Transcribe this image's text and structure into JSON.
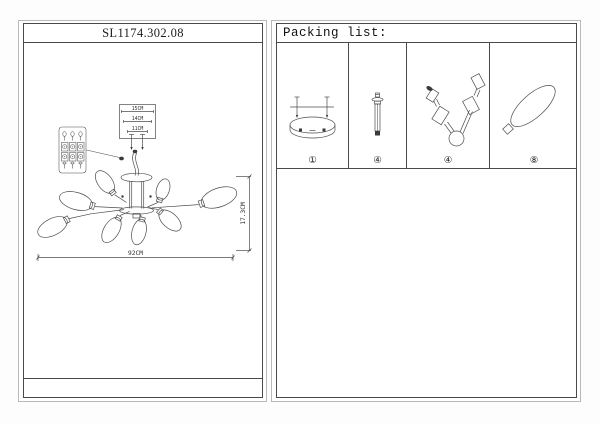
{
  "left_panel": {
    "title": "SL1174.302.08",
    "drawing": {
      "dim_top_outer": "15CM",
      "dim_top_mid": "14CM",
      "dim_top_inner": "11CM",
      "dim_height": "17.3CM",
      "dim_width": "92CM"
    }
  },
  "right_panel": {
    "header": "Packing list:",
    "items": [
      {
        "name": "ceiling-canopy",
        "qty_label": "①"
      },
      {
        "name": "mounting-screw",
        "qty_label": "④"
      },
      {
        "name": "lamp-arm",
        "qty_label": "④"
      },
      {
        "name": "glass-shade",
        "qty_label": "⑧"
      }
    ]
  },
  "colors": {
    "line": "#4d4d4d",
    "border_outer": "#b9b9b9",
    "border_inner": "#4a4a4a"
  }
}
